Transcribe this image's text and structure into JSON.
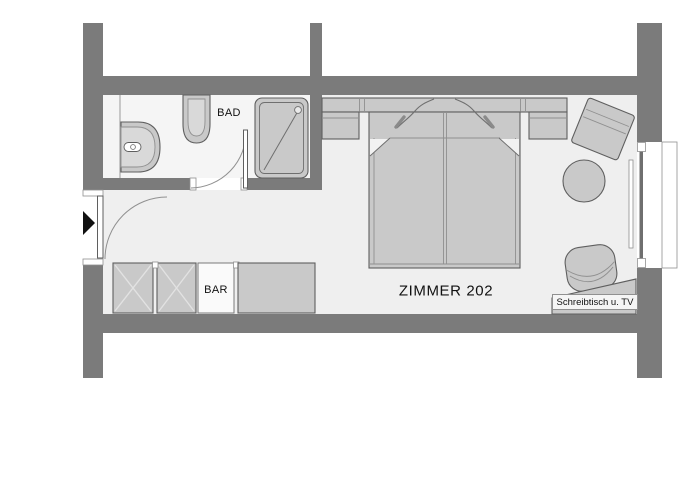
{
  "title": "Hotel room floor plan",
  "labels": {
    "room": "ZIMMER 202",
    "bathroom": "BAD",
    "minibar": "BAR",
    "desk": "Schreibtisch u. TV"
  },
  "colors": {
    "background": "#ffffff",
    "wall": "#7b7b7b",
    "floor-bathroom": "#f5f5f5",
    "floor-bedroom": "#efefef",
    "furniture": "#c9c9c9",
    "furniture-light": "#d9d9d9",
    "outline": "#5f5f5f",
    "outline-light": "#909090",
    "cross": "#e2e2e2",
    "text": "#111111"
  },
  "fixtures": [
    "entrance-door",
    "entrance-arrow",
    "bathroom-door",
    "washbasin",
    "toilet",
    "shower",
    "wardrobe",
    "minibar-cabinet",
    "sideboard",
    "double-bed",
    "nightstand-left",
    "nightstand-right",
    "armchair",
    "round-table",
    "desk-chair",
    "desk-with-tv",
    "window"
  ]
}
